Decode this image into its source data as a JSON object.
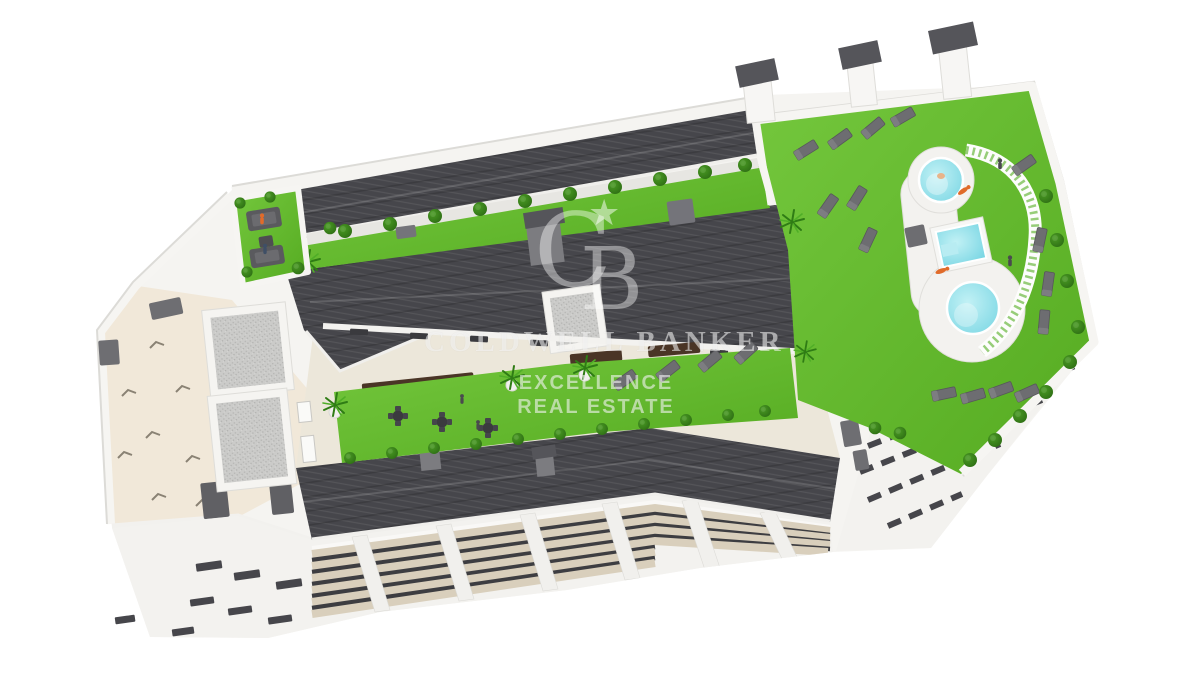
{
  "scene": {
    "type": "3D aerial architectural rendering",
    "subject": "Residential apartment building rooftop with garden terraces, swimming pool deck, sun loungers and chimneys",
    "background": "#ffffff"
  },
  "watermark": {
    "logo_letter_c": "C",
    "logo_letter_b": "B",
    "logo_star": "★",
    "brand_line": "COLDWELL BANKER",
    "sub_line_1": "EXCELLENCE",
    "sub_line_2": "REAL ESTATE"
  },
  "palette": {
    "roof_dark": "#46464b",
    "grass_green": "#5eb32b",
    "grass_light": "#74c73d",
    "grass_deep": "#55ab21",
    "bush_green": "#37831b",
    "pool_water": "#8fe0ea",
    "terrace_beige": "#f1e8d9",
    "balcony_beige": "#d9cfbc",
    "wall_white": "#f5f4f1",
    "wall_shadow": "#d8d7d3",
    "gravel_gray": "#c9c9c7",
    "lounger_gray": "#6d6d71",
    "pergola_brown": "#4a3526",
    "cap_gray": "#55555a"
  }
}
